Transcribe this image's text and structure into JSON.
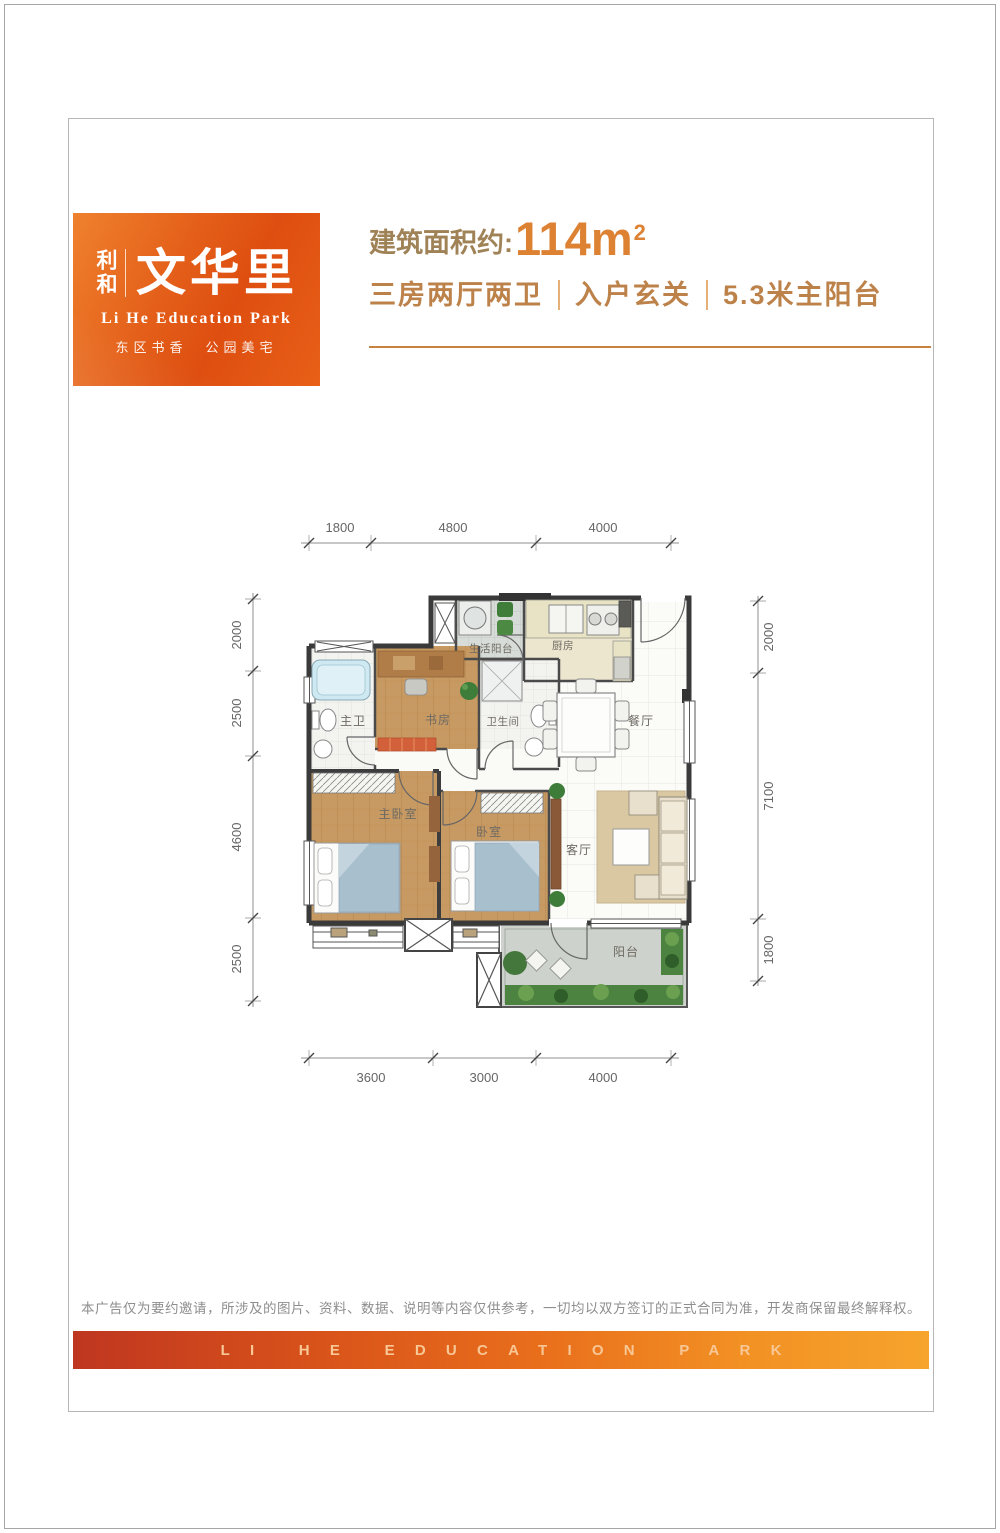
{
  "logo": {
    "name_small": "利和",
    "name_large": "文华里",
    "subtitle_en": "Li He Education Park",
    "slogan": "东区书香　公园美宅"
  },
  "header": {
    "area_label": "建筑面积约:",
    "area_value": "114m",
    "area_sup": "2",
    "features": [
      "三房两厅两卫",
      "入户玄关",
      "5.3米主阳台"
    ]
  },
  "floorplan": {
    "rooms": {
      "laundry_balcony": "生活阳台",
      "kitchen": "厨房",
      "master_bath": "主卫",
      "study": "书房",
      "bathroom": "卫生间",
      "dining": "餐厅",
      "master_bedroom": "主卧室",
      "bedroom": "卧室",
      "living": "客厅",
      "balcony": "阳台"
    },
    "dims_top": [
      "1800",
      "4800",
      "4000"
    ],
    "dims_left": [
      "2000",
      "2500",
      "4600",
      "2500"
    ],
    "dims_right": [
      "2000",
      "7100",
      "1800"
    ],
    "dims_bottom": [
      "3600",
      "3000",
      "4000"
    ]
  },
  "footer": {
    "disclaimer": "本广告仅为要约邀请，所涉及的图片、资料、数据、说明等内容仅供参考，一切均以双方签订的正式合同为准，开发商保留最终解释权。",
    "banner": "LI HE EDUCATION PARK"
  },
  "colors": {
    "brand_orange": "#e4601a",
    "accent_orange": "#dd8133",
    "headline_brown": "#a08257",
    "banner_text": "#f8c795",
    "wall": "#3a3a3a",
    "wood_floor": "#c89a63"
  }
}
